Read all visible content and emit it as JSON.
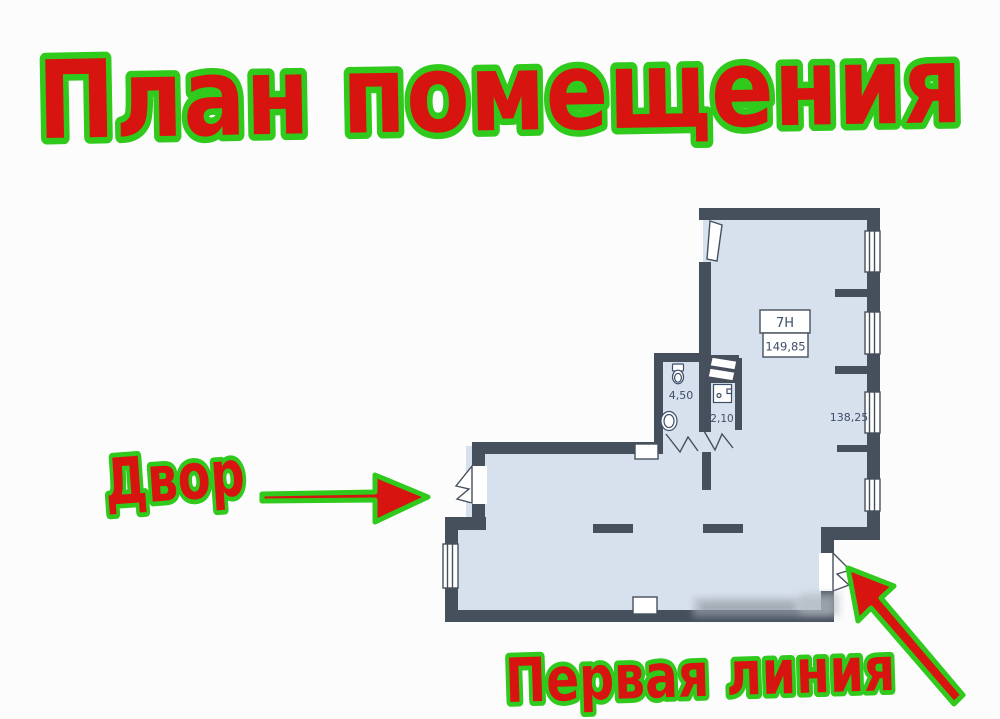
{
  "title": {
    "text": "План помещения"
  },
  "labels": {
    "yard": "Двор",
    "first_line": "Первая линия"
  },
  "plan": {
    "unit_label": "7Н",
    "unit_area": "149,85",
    "bathroom_area": "4,50",
    "hall_area": "2,10",
    "main_room_area": "138,25"
  },
  "colors": {
    "label_red": "#d81410",
    "label_green_outline": "#2fca1c",
    "wall": "#46505d",
    "floor": "#d7e1ed",
    "plan_text": "#3d4e68"
  }
}
